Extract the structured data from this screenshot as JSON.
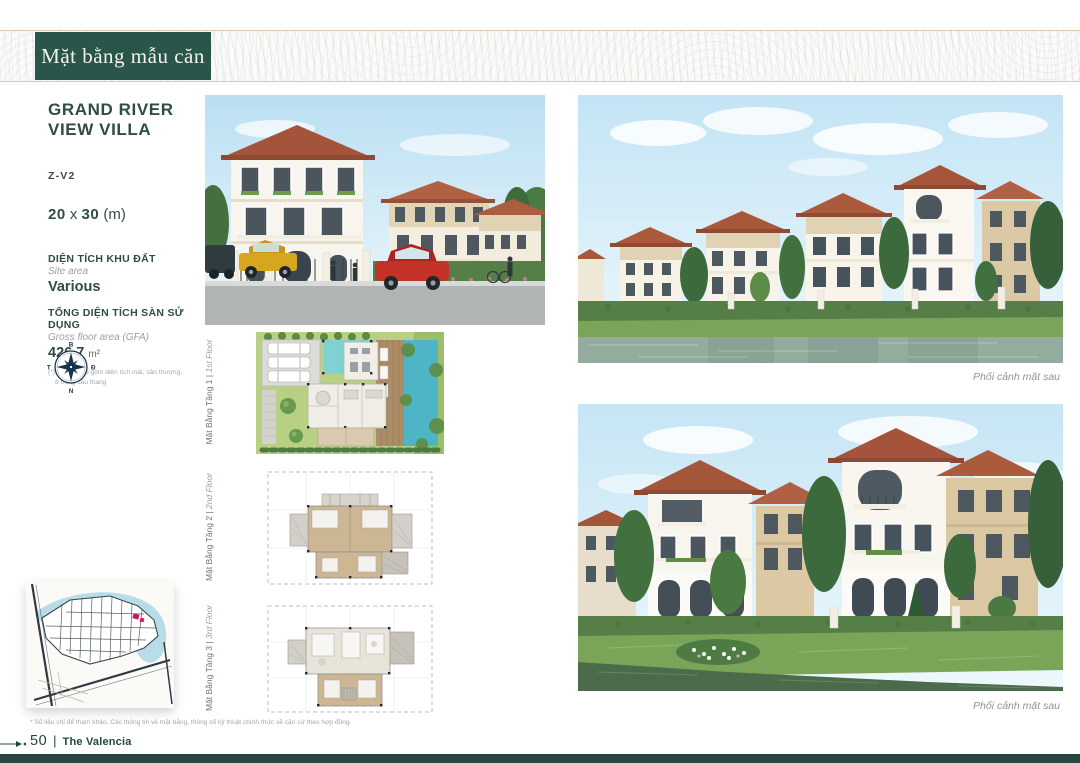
{
  "header": {
    "ribbon": "Mặt bằng mẫu căn"
  },
  "info": {
    "title_line1": "GRAND RIVER",
    "title_line2": "VIEW VILLA",
    "code": "Z-V2",
    "dim_w": "20",
    "dim_sep": " x ",
    "dim_h": "30",
    "dim_unit": " (m)",
    "site_label_vi": "DIỆN TÍCH KHU ĐẤT",
    "site_label_en": "Site area",
    "site_value": "Various",
    "gfa_label_vi": "TỔNG DIỆN TÍCH SÀN SỬ DỤNG",
    "gfa_label_en": "Gross floor area (GFA)",
    "gfa_value": "426.7",
    "gfa_unit": "m²",
    "gfa_note_line1": "(*) Không bao gồm diện tích mái, sân thượng,",
    "gfa_note_line2": "ô trống cầu thang"
  },
  "compass": {
    "north": "B",
    "east": "Đ",
    "south": "N",
    "west": "T"
  },
  "floorplans": [
    {
      "label_vi": "Mặt Bằng Tầng 1",
      "sep": " | ",
      "label_en": "1st Floor"
    },
    {
      "label_vi": "Mặt Bằng Tầng 2",
      "sep": " | ",
      "label_en": "2nd Floor"
    },
    {
      "label_vi": "Mặt Bằng Tầng 3",
      "sep": " | ",
      "label_en": "3rd Floor"
    }
  ],
  "renders": {
    "caption_top": "Phối cảnh mặt sau",
    "caption_bottom": "Phối cảnh mặt sau"
  },
  "footer": {
    "note": "* Số liệu chỉ để tham khảo. Các thông tin về mặt bằng, thông số kỹ thuật chính thức sẽ căn cứ theo hợp đồng.",
    "page_number": "50",
    "separator": "|",
    "brand": "The Valencia"
  },
  "colors": {
    "brand_green": "#2a554a",
    "bar_green": "#24483e",
    "compass_navy": "#16324c",
    "marker_red": "#c2185b"
  }
}
